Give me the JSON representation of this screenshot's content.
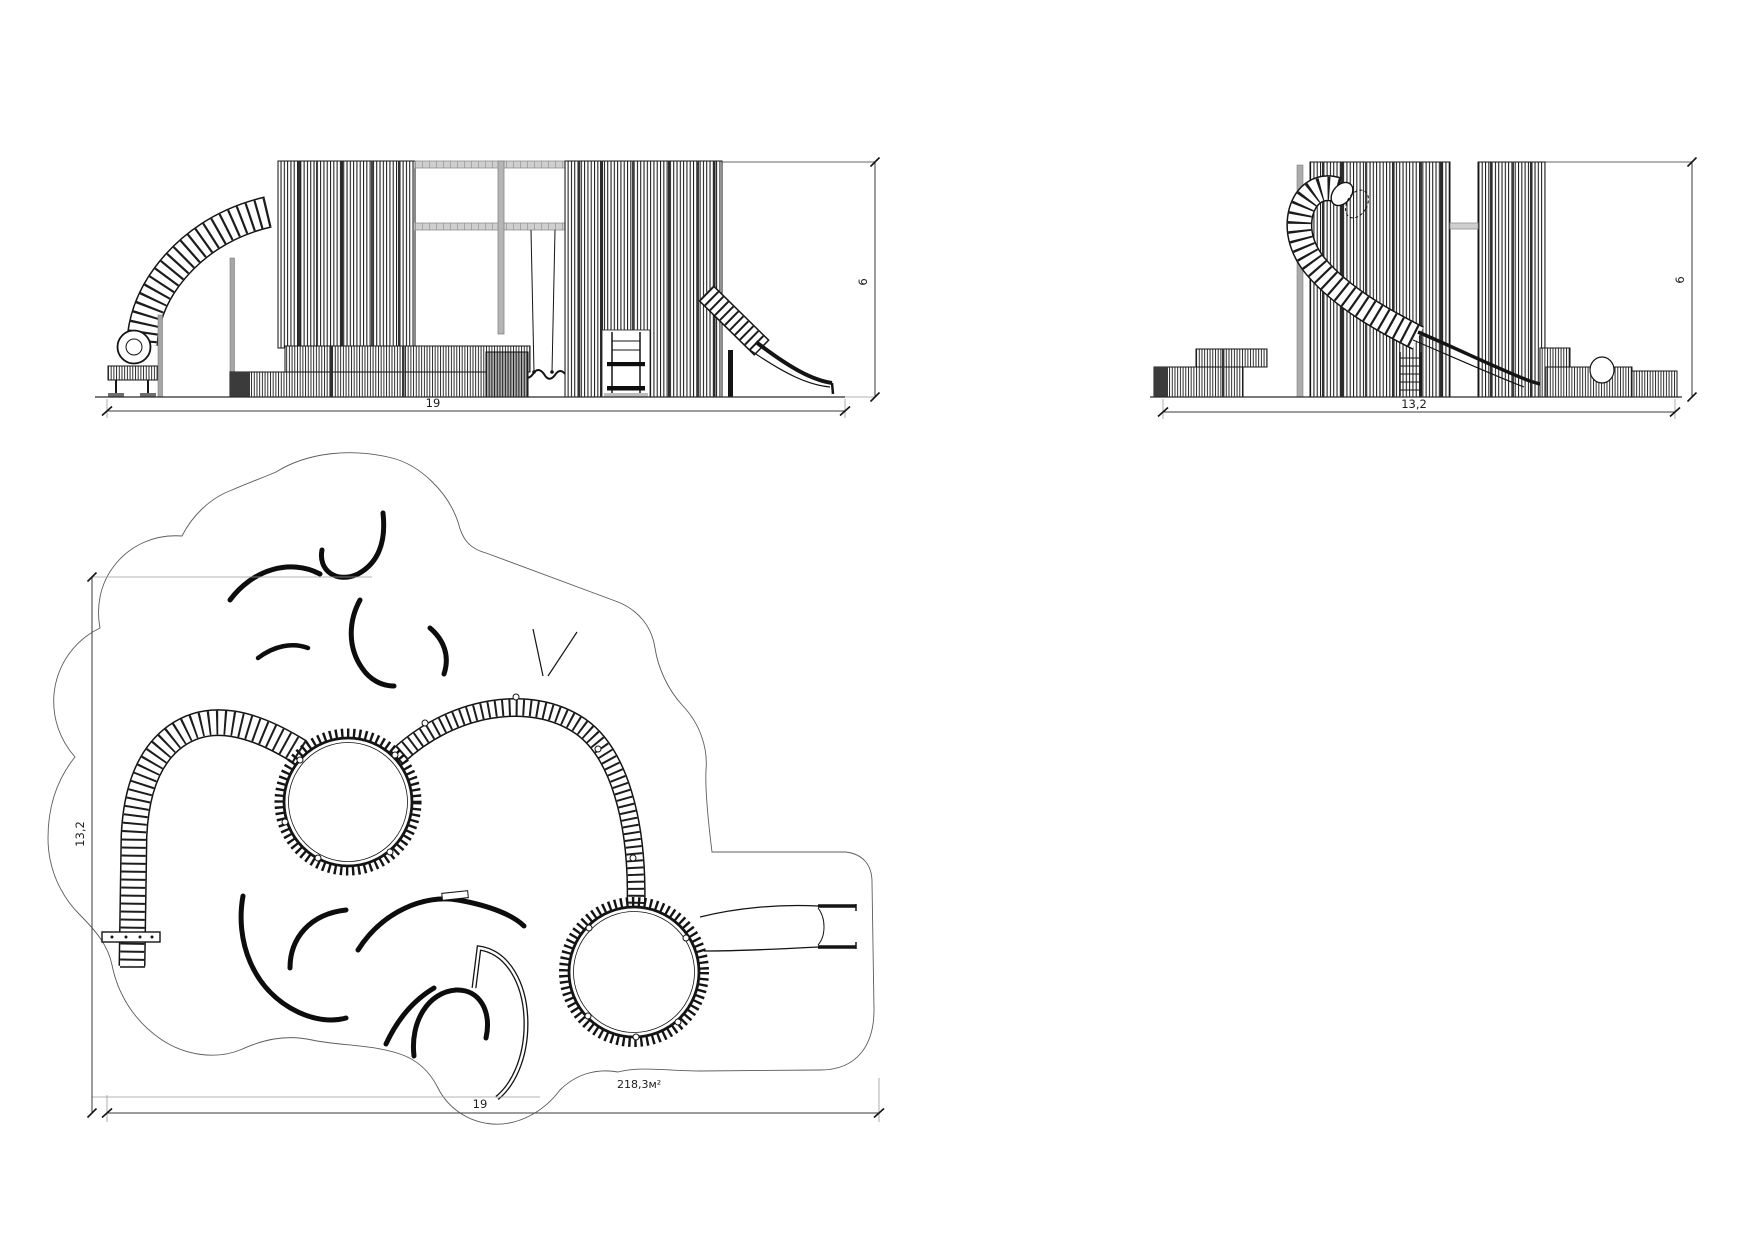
{
  "drawing": {
    "type": "playground equipment technical drawing",
    "colors": {
      "background": "#ffffff",
      "line": "#161616",
      "gray_member": "#a6a6a6",
      "dimension": "#2e2e2e"
    },
    "front_elevation": {
      "width_dim": "19",
      "height_dim": "6"
    },
    "side_elevation": {
      "width_dim": "13,2",
      "height_dim": "6"
    },
    "plan": {
      "width_dim": "19",
      "height_dim": "13,2",
      "area_label": "218,3м²"
    }
  }
}
